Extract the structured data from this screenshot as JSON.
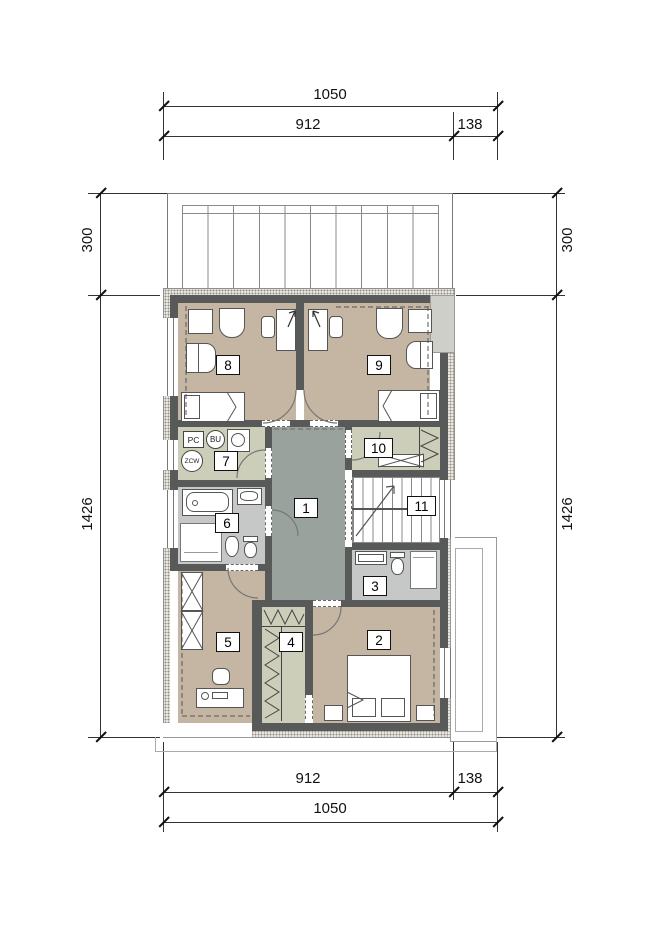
{
  "drawing": {
    "dims_top": {
      "total": "1050",
      "main": "912",
      "side": "138"
    },
    "dims_bottom": {
      "main": "912",
      "side": "138",
      "total": "1050"
    },
    "dims_left": {
      "balcony": "300",
      "body": "1426"
    },
    "dims_right": {
      "balcony": "300",
      "body": "1426"
    },
    "rooms": {
      "r1": "1",
      "r2": "2",
      "r3": "3",
      "r4": "4",
      "r5": "5",
      "r6": "6",
      "r7": "7",
      "r8": "8",
      "r9": "9",
      "r10": "10",
      "r11": "11"
    },
    "equipment": {
      "pc": "PC",
      "bu": "BU",
      "zcw": "ZCW"
    },
    "colors": {
      "wall": "#575a59",
      "floor_bedroom": "#c4b6a2",
      "floor_hall": "#99a29d",
      "floor_bath": "#c5c8c7",
      "floor_aux": "#cdceba",
      "hatch_bg": "#e7e5df"
    }
  }
}
